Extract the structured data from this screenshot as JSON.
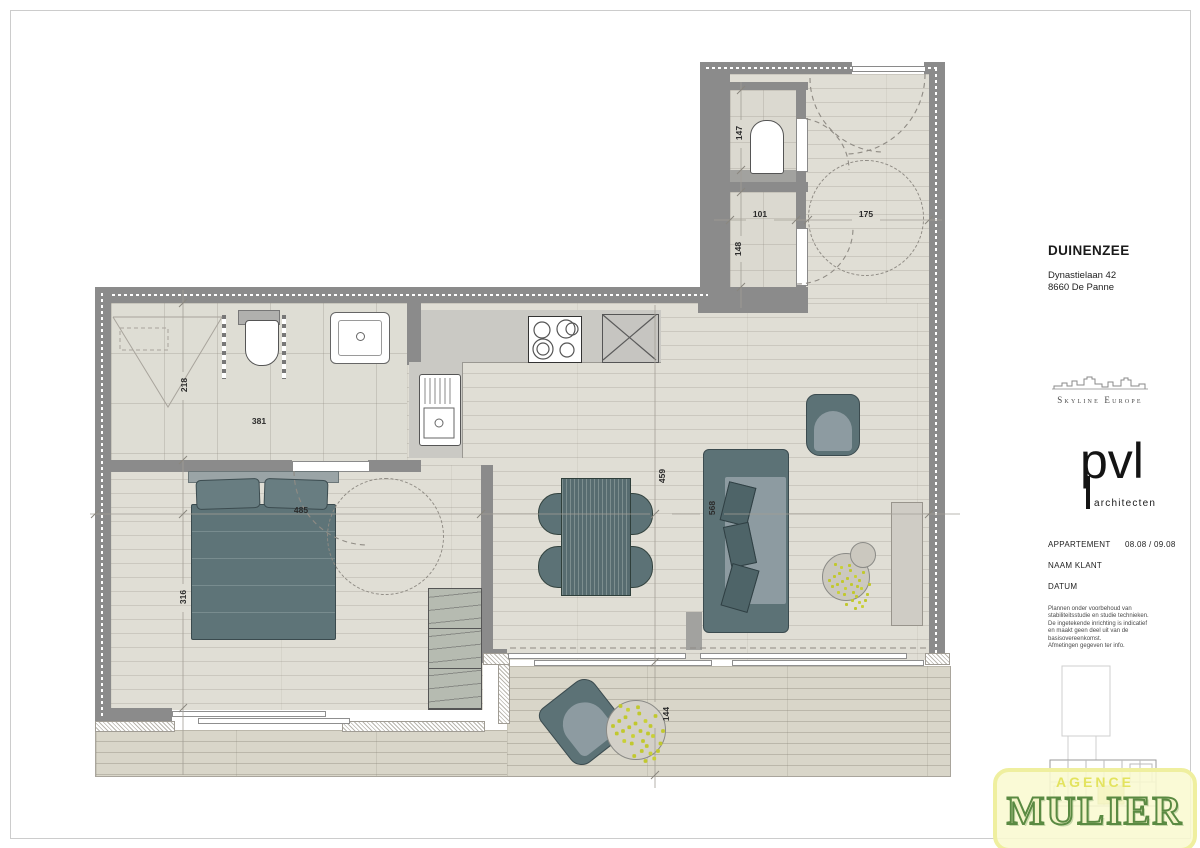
{
  "title_block": {
    "project": "DUINENZEE",
    "address_line1": "Dynastielaan 42",
    "address_line2": "8660 De Panne",
    "developer_logo": "Skyline Europe",
    "architect_logo": "pvl",
    "architect_sub": "architecten",
    "apartment_label": "APPARTEMENT",
    "apartment_value": "08.08 / 09.08",
    "client_label": "NAAM KLANT",
    "date_label": "DATUM",
    "disclaimer_lines": [
      "Plannen onder voorbehoud van",
      "stabiliteitsstudie en studie technieken.",
      "De ingetekende inrichting is indicatief",
      "en maakt geen deel uit van de",
      "basisovereenkomst.",
      "Afmetingen gegeven ter info."
    ]
  },
  "watermark": {
    "line1": "AGENCE",
    "line2": "MULIER"
  },
  "plan": {
    "dims": {
      "shower_diag": "218",
      "bathroom_width": "381",
      "bed_width": "485",
      "bedroom_depth": "316",
      "dining_depth": "459",
      "sofa_length": "568",
      "terrace_depth": "144",
      "wc_depth": "147",
      "storage_width": "101",
      "storage_depth": "148",
      "hall_width": "175"
    },
    "palette": {
      "wall": "#8b8b8b",
      "floor": "#e0ded5",
      "terrace": "#d9d6c9",
      "furniture_dark": "#5c7276",
      "furniture_seat": "#8d9ba1",
      "plant": "#c1c82e",
      "watermark_bg": "#f9f9d0",
      "watermark_green": "#5a8a42"
    }
  }
}
